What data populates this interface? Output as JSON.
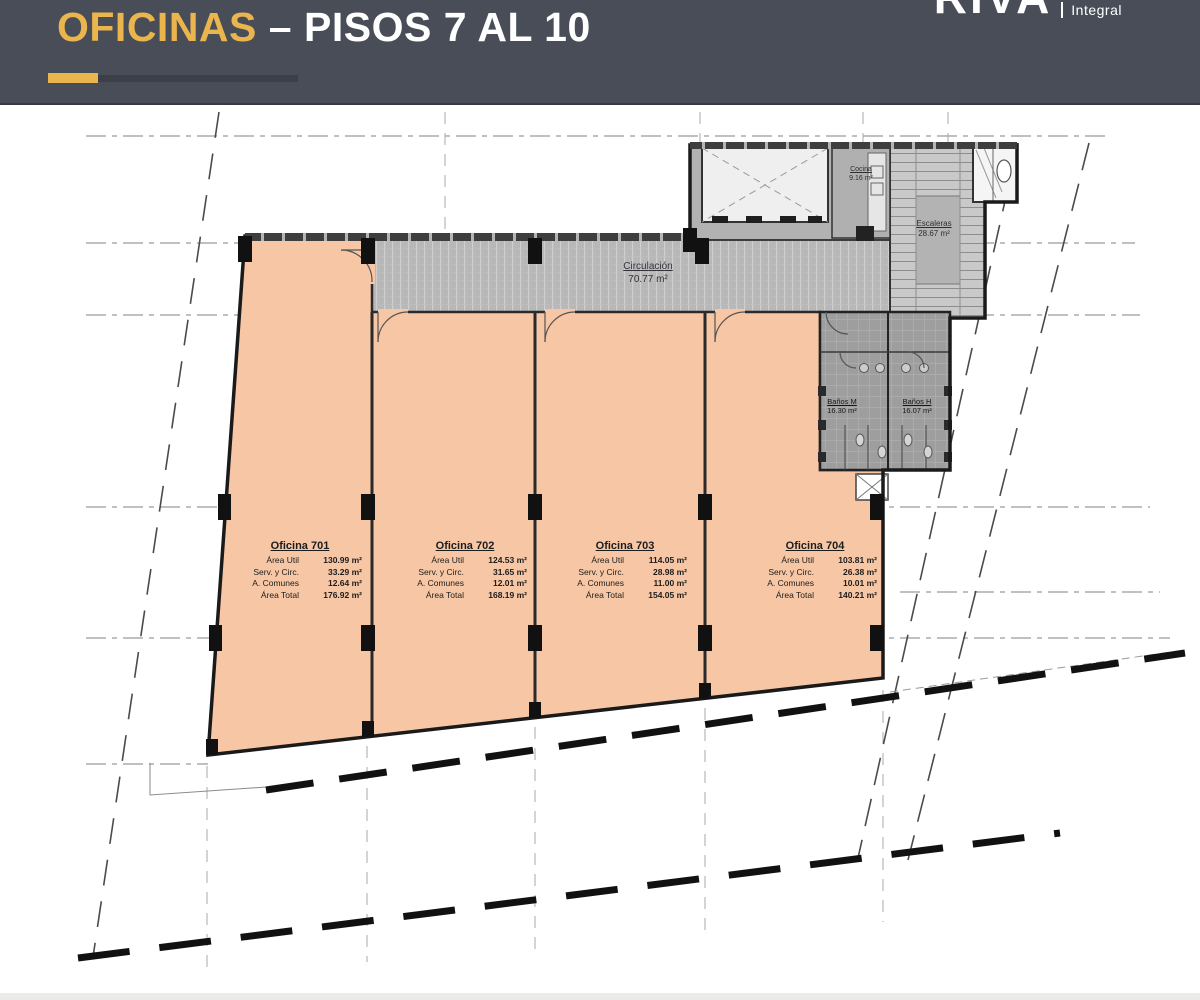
{
  "header": {
    "title_highlight": "OFICINAS",
    "title_rest": " – PISOS 7 AL 10",
    "logo_main": "RIVA",
    "logo_sub": "Integral",
    "colors": {
      "bar_bg": "#484d58",
      "accent_gold": "#eab54d",
      "title_text": "#ffffff"
    }
  },
  "plan": {
    "circulation": {
      "title": "Circulación",
      "area": "70.77 m²"
    },
    "stairs": {
      "title": "Escaleras",
      "area": "28.67 m²"
    },
    "kitchen": {
      "title": "Cocina",
      "area": "9.16 m²"
    },
    "bathroom_m": {
      "title": "Baños M",
      "area": "16.30 m²"
    },
    "bathroom_h": {
      "title": "Baños H",
      "area": "16.07 m²"
    },
    "offices": [
      {
        "title": "Oficina 701",
        "rows": [
          {
            "label": "Área Util",
            "value": "130.99 m²"
          },
          {
            "label": "Serv. y Circ.",
            "value": "33.29 m²"
          },
          {
            "label": "A. Comunes",
            "value": "12.64 m²"
          },
          {
            "label": "Área Total",
            "value": "176.92 m²"
          }
        ]
      },
      {
        "title": "Oficina 702",
        "rows": [
          {
            "label": "Área Util",
            "value": "124.53 m²"
          },
          {
            "label": "Serv. y Circ.",
            "value": "31.65 m²"
          },
          {
            "label": "A. Comunes",
            "value": "12.01 m²"
          },
          {
            "label": "Área Total",
            "value": "168.19 m²"
          }
        ]
      },
      {
        "title": "Oficina 703",
        "rows": [
          {
            "label": "Área Util",
            "value": "114.05 m²"
          },
          {
            "label": "Serv. y Circ.",
            "value": "28.98 m²"
          },
          {
            "label": "A. Comunes",
            "value": "11.00 m²"
          },
          {
            "label": "Área Total",
            "value": "154.05 m²"
          }
        ]
      },
      {
        "title": "Oficina 704",
        "rows": [
          {
            "label": "Área Util",
            "value": "103.81 m²"
          },
          {
            "label": "Serv. y Circ.",
            "value": "26.38 m²"
          },
          {
            "label": "A. Comunes",
            "value": "10.01 m²"
          },
          {
            "label": "Área Total",
            "value": "140.21 m²"
          }
        ]
      }
    ],
    "colors": {
      "office_fill": "#f7c7a5",
      "corridor_fill": "#b8b8b8",
      "core_fill": "#b2b2b2",
      "bathroom_fill": "#9e9e9e",
      "wall": "#1f1f1f"
    }
  }
}
